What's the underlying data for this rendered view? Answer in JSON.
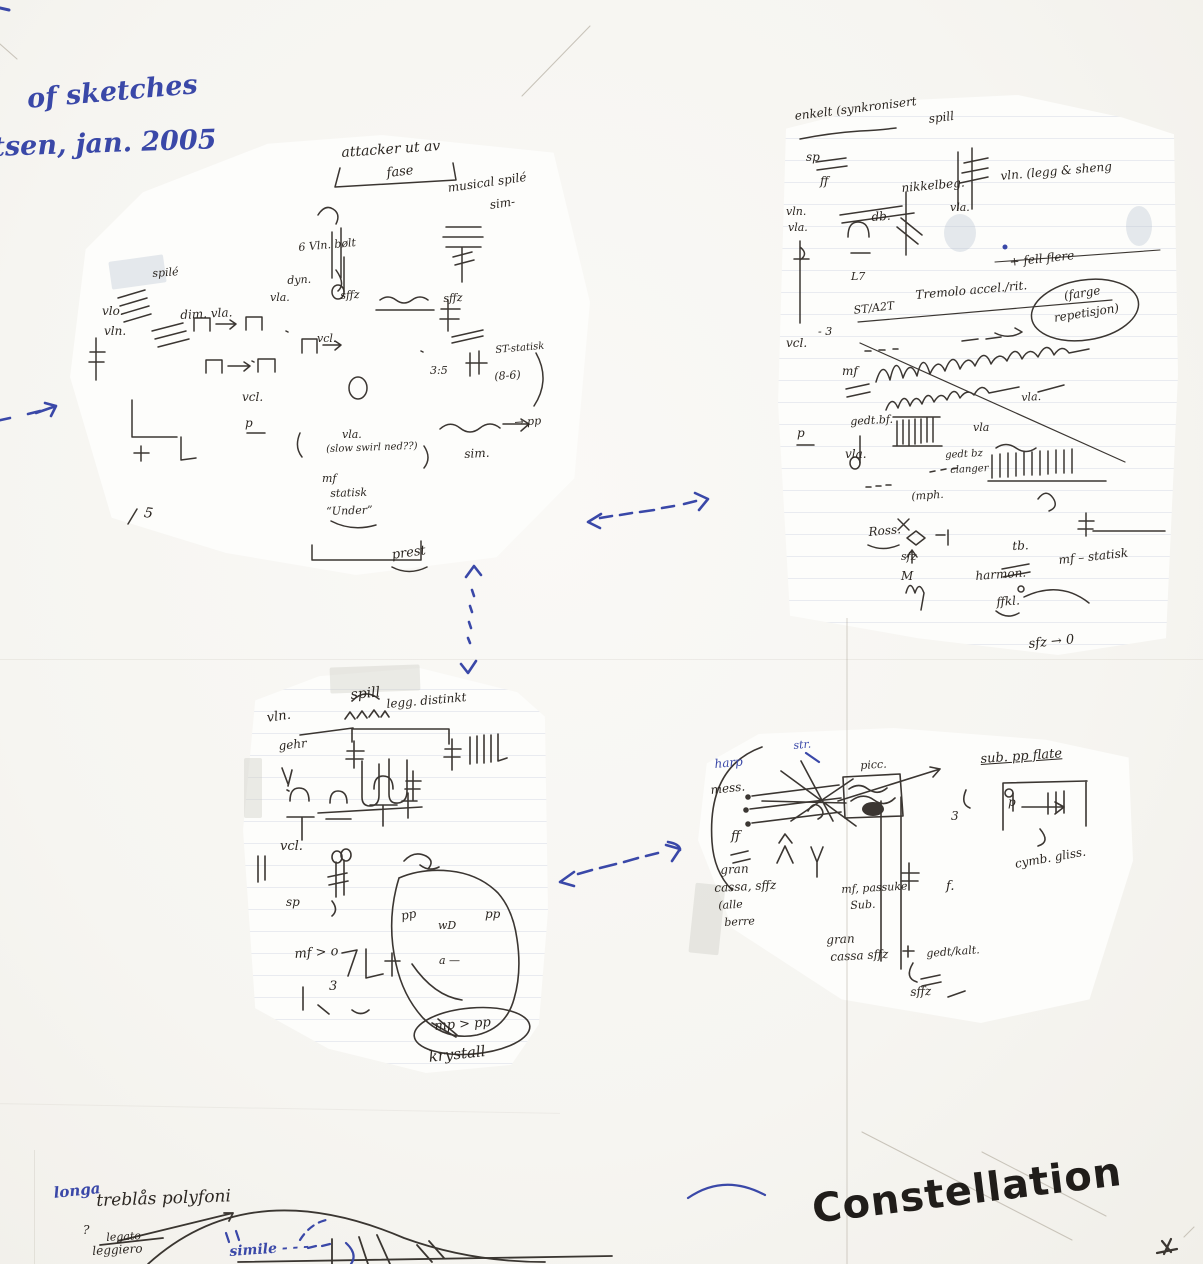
{
  "colors": {
    "paper": "#f7f6f3",
    "fragment_paper": "#fdfdfb",
    "ink_black": "#2b2621",
    "ink_blue": "#3a48a8",
    "marker_black": "#201d1a",
    "rule_line": "#6e7daa"
  },
  "header_note": {
    "line1": "of sketches",
    "line2": "tsen, jan. 2005"
  },
  "arrows": {
    "left_entry": "dashed arrow pointing right into left sketch",
    "top_pair": "dashed double-headed arrow between top sketches",
    "vertical_pair": "dotted double-headed arrow between upper and lower sketches",
    "bottom_pair": "dashed double-headed arrow between bottom sketches"
  },
  "clusters": {
    "top_left": {
      "labels": {
        "attacker": "attacker ut av",
        "fase": "fase",
        "musical": "musical spilé",
        "sim_dash": "sim-",
        "spile": "spilé",
        "vlo": "vlo.",
        "vln": "vln.",
        "dim_vla": "dim. vla.",
        "six_vln": "6 Vln. bølt",
        "dyn": "dyn.",
        "vla1": "vla.",
        "sffz1": "sffz",
        "vcl1": "vcl.",
        "sffz2": "sffz",
        "st_statisk": "ST-statisk",
        "ratio": "3:5",
        "v86": "(8-6)",
        "vcl2": "vcl.",
        "p": "p",
        "vla2": "vla.",
        "slow_swirl": "(slow swirl ned??)",
        "sim": "sim.",
        "pp": "→ pp",
        "mf": "mf",
        "statisk": "statisk",
        "under": "“Under”",
        "five": "5",
        "prest": "prest"
      }
    },
    "top_right": {
      "labels": {
        "header": "enkelt (synkronisert",
        "spill": "spill",
        "sp": "sp",
        "ff": "ff",
        "vln": "vln.",
        "vla": "vla.",
        "db": "db.",
        "nikkel": "nikkelbeg.",
        "vla_mid": "vla.",
        "vln_legg": "vln. (legg & sheng",
        "l7": "L7",
        "fell_flere": "+ fell flere",
        "tremolo": "Tremolo accel./rit.",
        "farge": "(farge",
        "repetisjon": "repetisjon)",
        "st_a2t": "ST/A2T",
        "minus3": "- 3",
        "vcl": "vcl.",
        "mf": "mf",
        "vla3": "vla.",
        "gedt": "gedt.bf.",
        "vla4": "vla",
        "p": "p",
        "vla5": "vla.",
        "gedt2": "gedt bz",
        "clanger": "clanger",
        "mph": "(mph.",
        "ross": "Ross.",
        "sfz": "sfz",
        "m": "M",
        "tb": "tb.",
        "mf_statisk": "mf – statisk",
        "harmon": "harmon.",
        "ffkl": "ffkl.",
        "sfz0": "sfz → 0"
      }
    },
    "bottom_middle": {
      "labels": {
        "spill": "spill",
        "distinkt": "legg. distinkt",
        "vln": "vln.",
        "gehr": "gehr",
        "vcl": "vcl.",
        "sp": "sp",
        "mf": "mf > o",
        "three": "3",
        "pp1": "pp",
        "wd": "wD",
        "pp2": "pp",
        "a_dash": "a —",
        "mp_pp": "mp > pp",
        "krystall": "krystall"
      }
    },
    "bottom_right": {
      "labels": {
        "str": "str.",
        "harp": "harp",
        "mess": "mess.",
        "picc": "picc.",
        "sub_pp": "sub. pp flate",
        "ff": "ff",
        "gran1": "gran",
        "cassa1": "cassa, sffz",
        "alle": "(alle",
        "berre": "berre",
        "mf_pass": "mf, passuke",
        "sub": "Sub.",
        "gran2": "gran",
        "cassa2": "cassa sffz",
        "f": "f.",
        "three": "3",
        "p": "p",
        "cymb": "cymb. gliss.",
        "gedt": "gedt/kalt.",
        "sffz": "sffz"
      }
    }
  },
  "footer": {
    "longa": "longa",
    "treblas": "treblås polyfoni",
    "question": "?",
    "legato": "legato",
    "leggiero": "leggiero",
    "simile": "simile - - -"
  },
  "title": "Constellation"
}
